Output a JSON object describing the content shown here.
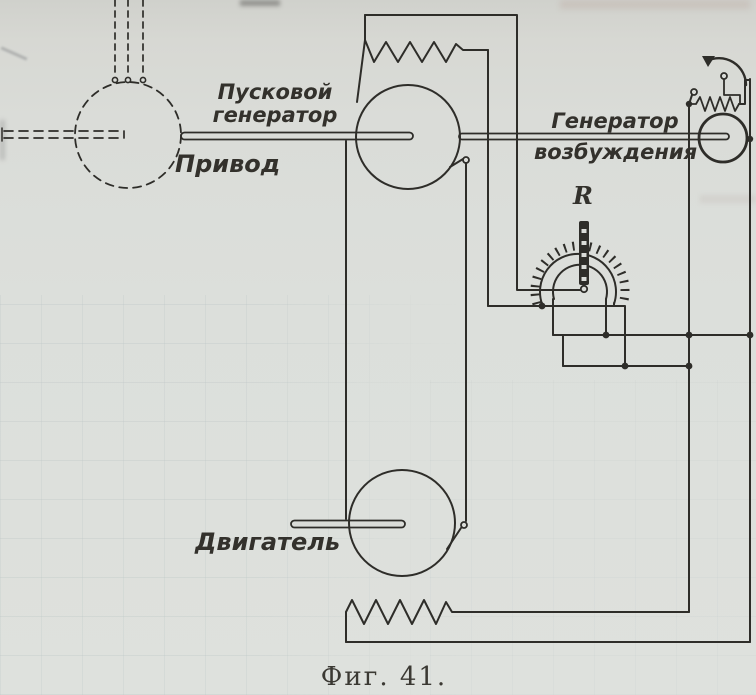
{
  "figure": {
    "caption": "Фиг. 41.",
    "labels": {
      "starting_generator": "Пусковой\nгенератор",
      "drive": "Привод",
      "excitation_generator": "Генератор\nвозбуждения",
      "motor": "Двигатель",
      "rheostat": "R"
    },
    "colors": {
      "paper": "#dadcd8",
      "ink": "#2e2d29",
      "caption_ink": "#3b3933",
      "bleed_grid": "#96a8ac"
    }
  }
}
